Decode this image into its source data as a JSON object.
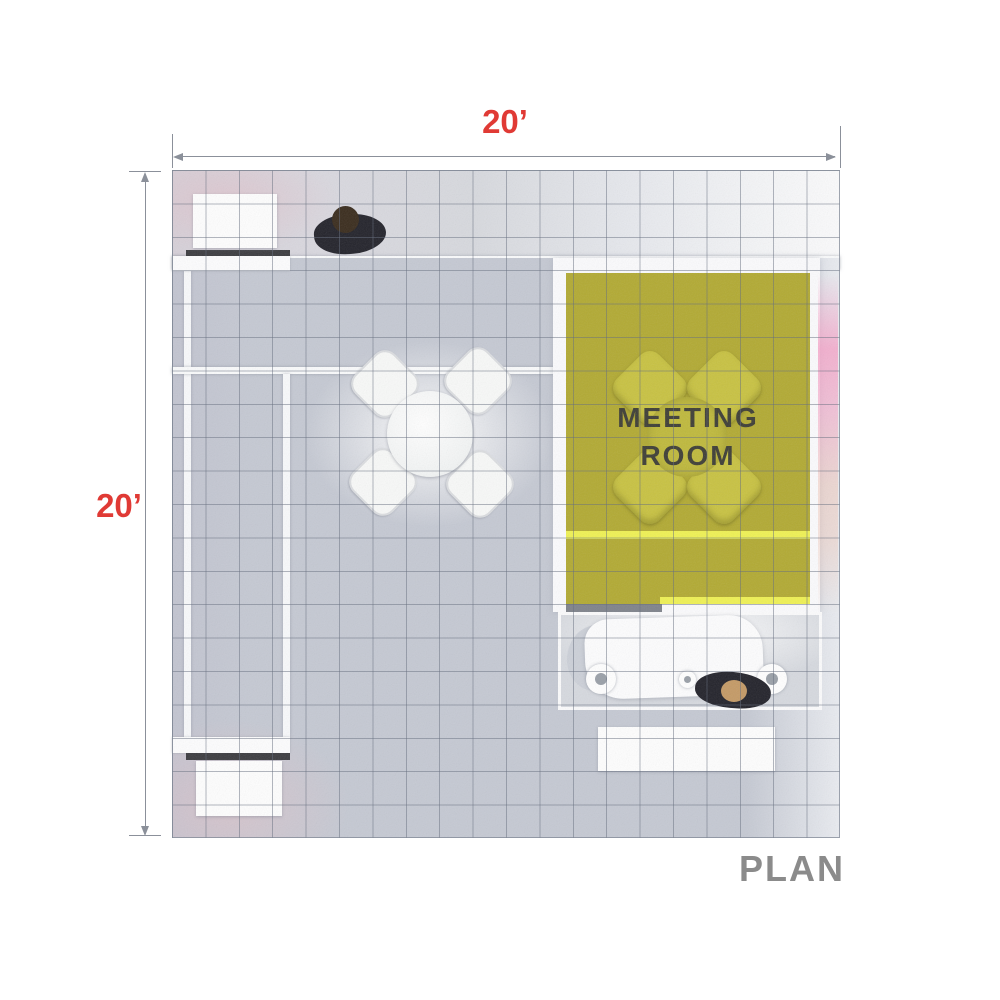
{
  "annotations": {
    "plan_label": "PLAN",
    "top_dimension": "20’",
    "left_dimension": "20’"
  },
  "meeting_room": {
    "label_line1": "MEETING",
    "label_line2": "ROOM"
  },
  "colors": {
    "dimension_red": "#e03a35",
    "plan_label_gray": "#8b8b8b",
    "meeting_room_olive": "#b2aa33",
    "accent_stripe_yellow": "#eff154",
    "carpet_gray": "#c6cad3",
    "grid_line_gray": "#687080",
    "meeting_room_text": "#3e3e36",
    "counter_edge_dark": "#3c3c40",
    "pink_wall_glow": "#f6a0c6"
  }
}
